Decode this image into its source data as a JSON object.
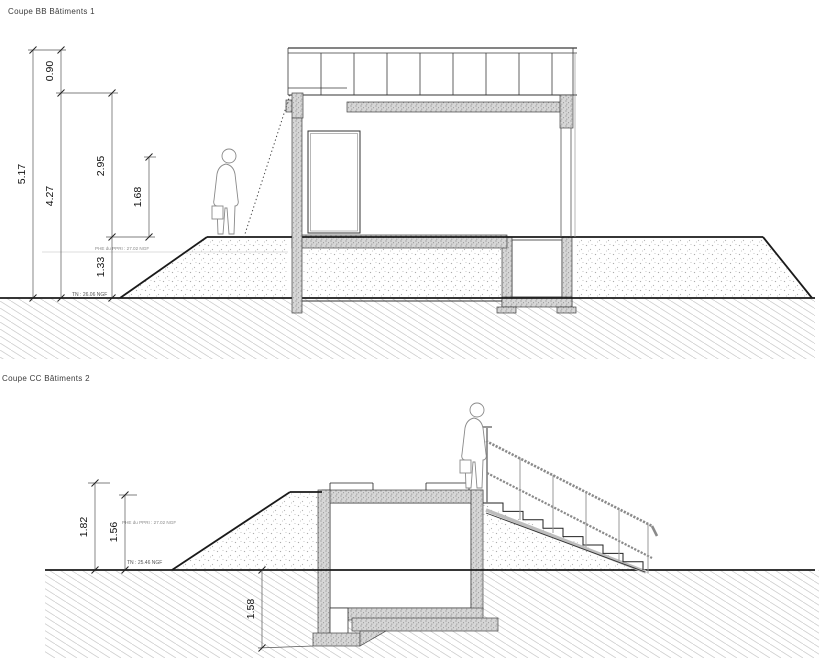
{
  "page": {
    "background": "#ffffff"
  },
  "colors": {
    "ground_line": "#1a1a1a",
    "concrete_fill": "#d5d5d5",
    "dimension_line": "#444444",
    "railing_gray": "#8a8a8a",
    "hatch_gray": "#cfcfcf"
  },
  "drawings": [
    {
      "id": "coupe-bb",
      "title": "Coupe BB  Bâtiments 1",
      "dimensions": {
        "overall": "5.17",
        "railing": "0.90",
        "wall_to_ground": "4.27",
        "upper": "2.95",
        "inner": "1.68",
        "embankment": "1.33"
      },
      "annotations": {
        "flood": "PHE du PPRI : 27.02 NGF",
        "terrain": "TN : 26.06 NGF"
      }
    },
    {
      "id": "coupe-cc",
      "title": "Coupe CC  Bâtiments 2",
      "dimensions": {
        "overall": "1.82",
        "flood": "1.56",
        "depth": "1.58"
      },
      "annotations": {
        "flood": "PHE du PPRI : 27.02 NGF",
        "terrain": "TN : 25.46 NGF"
      }
    }
  ]
}
